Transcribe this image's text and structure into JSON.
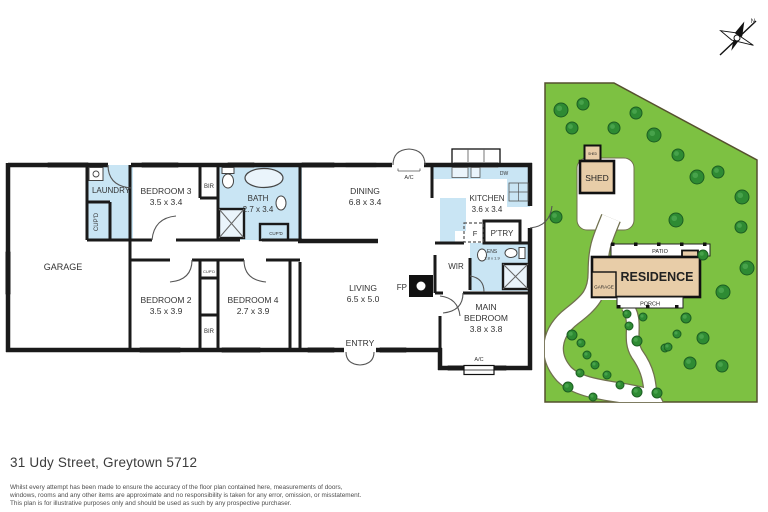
{
  "page": {
    "address": "31 Udy Street, Greytown 5712",
    "disclaimer_lines": [
      "Whilst every attempt has been made to ensure the accuracy of the floor plan contained here, measurements of doors,",
      "windows, rooms and any other items are approximate and no responsibility is taken for any error, omission, or misstatement.",
      "This plan is for illustrative purposes only and should be used as such by any prospective purchaser."
    ]
  },
  "compass": {
    "north_label": "N"
  },
  "floor_plan": {
    "wet_area_color": "#c9e5f4",
    "wall_color": "#1a1a1a",
    "rooms": [
      {
        "id": "garage",
        "lines": [
          "GARAGE"
        ],
        "x": 63,
        "y": 270,
        "size": 9
      },
      {
        "id": "laundry",
        "lines": [
          "LAUNDRY"
        ],
        "x": 111,
        "y": 193,
        "size": 8
      },
      {
        "id": "bedroom-3",
        "lines": [
          "BEDROOM 3",
          "3.5 x 3.4"
        ],
        "x": 166,
        "y": 194,
        "size": 8.5
      },
      {
        "id": "bath",
        "lines": [
          "BATH",
          "2.7 x 3.4"
        ],
        "x": 258,
        "y": 201,
        "size": 8
      },
      {
        "id": "dining",
        "lines": [
          "DINING",
          "6.8 x 3.4"
        ],
        "x": 365,
        "y": 194,
        "size": 8.5
      },
      {
        "id": "kitchen",
        "lines": [
          "KITCHEN",
          "3.6 x 3.4"
        ],
        "x": 487,
        "y": 201,
        "size": 8
      },
      {
        "id": "living",
        "lines": [
          "LIVING",
          "6.5 x 5.0"
        ],
        "x": 363,
        "y": 291,
        "size": 8.5
      },
      {
        "id": "bedroom-2",
        "lines": [
          "BEDROOM 2",
          "3.5 x 3.9"
        ],
        "x": 166,
        "y": 303,
        "size": 8.5
      },
      {
        "id": "bedroom-4",
        "lines": [
          "BEDROOM 4",
          "2.7 x 3.9"
        ],
        "x": 253,
        "y": 303,
        "size": 8.5
      },
      {
        "id": "main-bedroom",
        "lines": [
          "MAIN",
          "BEDROOM",
          "3.8 x 3.8"
        ],
        "x": 486,
        "y": 310,
        "size": 8.5
      },
      {
        "id": "wir",
        "lines": [
          "WIR"
        ],
        "x": 456,
        "y": 269,
        "size": 8
      },
      {
        "id": "entry",
        "lines": [
          "ENTRY"
        ],
        "x": 360,
        "y": 346,
        "size": 8.5
      }
    ],
    "small_labels": [
      {
        "id": "bir-bed3",
        "text": "BIR",
        "x": 209,
        "y": 188,
        "size": 6
      },
      {
        "id": "cupd-laundry",
        "text": "CUP'D",
        "x": 98,
        "y": 222,
        "size": 6,
        "rotate": -90
      },
      {
        "id": "cupd-bath",
        "text": "CUP'D",
        "x": 276,
        "y": 235,
        "size": 4.5
      },
      {
        "id": "cupd-hall",
        "text": "CUP'D",
        "x": 209,
        "y": 273,
        "size": 4
      },
      {
        "id": "bir-hall",
        "text": "BIR",
        "x": 209,
        "y": 333,
        "size": 6
      },
      {
        "id": "dw",
        "text": "DW",
        "x": 504,
        "y": 175,
        "size": 5
      },
      {
        "id": "fridge",
        "text": "F",
        "x": 475,
        "y": 236,
        "size": 7.5
      },
      {
        "id": "pantry",
        "text": "P'TRY",
        "x": 502,
        "y": 236,
        "size": 8
      },
      {
        "id": "ens",
        "text": "ENS",
        "x": 492,
        "y": 253,
        "size": 5
      },
      {
        "id": "ens-dims",
        "text": "1.8 x 1.9",
        "x": 492,
        "y": 259.5,
        "size": 4
      },
      {
        "id": "fp",
        "text": "FP",
        "x": 407,
        "y": 290,
        "size": 8,
        "anchor": "end"
      },
      {
        "id": "ac-dining",
        "text": "A/C",
        "x": 409,
        "y": 179,
        "size": 5.5
      },
      {
        "id": "ac-mainbed",
        "text": "A/C",
        "x": 479,
        "y": 361,
        "size": 5.5
      }
    ]
  },
  "site_plan": {
    "colors": {
      "grass": "#7dc142",
      "grass_border": "#55502e",
      "tree": "#2e8b33",
      "tree_dark": "#1c5e22",
      "tree_light": "#5cb65f",
      "building": "#e8cda8",
      "drive_border": "#70704e"
    },
    "labels": [
      {
        "id": "shed",
        "text": "SHED",
        "x": 597,
        "y": 181,
        "size": 8.5
      },
      {
        "id": "small-shed",
        "text": "SHED",
        "x": 592.5,
        "y": 155,
        "size": 3.2
      },
      {
        "id": "residence",
        "text": "RESIDENCE",
        "x": 657,
        "y": 281,
        "size": 12.5,
        "bold": true
      },
      {
        "id": "site-garage",
        "text": "GARAGE",
        "x": 604,
        "y": 288.5,
        "size": 4.6
      },
      {
        "id": "patio",
        "text": "PATIO",
        "x": 660,
        "y": 253,
        "size": 5.5
      },
      {
        "id": "porch",
        "text": "PORCH",
        "x": 650,
        "y": 305.5,
        "size": 5.5
      }
    ],
    "trees": [
      [
        561,
        110,
        7
      ],
      [
        583,
        104,
        6
      ],
      [
        572,
        128,
        6
      ],
      [
        614,
        128,
        6
      ],
      [
        636,
        113,
        6
      ],
      [
        654,
        135,
        7
      ],
      [
        678,
        155,
        6
      ],
      [
        697,
        177,
        7
      ],
      [
        718,
        172,
        6
      ],
      [
        742,
        197,
        7
      ],
      [
        556,
        217,
        6
      ],
      [
        676,
        220,
        7
      ],
      [
        741,
        227,
        6
      ],
      [
        747,
        268,
        7
      ],
      [
        723,
        292,
        7
      ],
      [
        703,
        338,
        6
      ],
      [
        690,
        363,
        6
      ],
      [
        722,
        366,
        6
      ],
      [
        627,
        314,
        4
      ],
      [
        643,
        317,
        4
      ],
      [
        629,
        326,
        4
      ],
      [
        686,
        318,
        5
      ],
      [
        677,
        334,
        4
      ],
      [
        665,
        348,
        4
      ],
      [
        572,
        335,
        5
      ],
      [
        581,
        343,
        4
      ],
      [
        637,
        341,
        5
      ],
      [
        668,
        347,
        4
      ],
      [
        587,
        355,
        4
      ],
      [
        595,
        365,
        4
      ],
      [
        580,
        373,
        4
      ],
      [
        607,
        375,
        4
      ],
      [
        568,
        387,
        5
      ],
      [
        620,
        385,
        4
      ],
      [
        593,
        397,
        4
      ],
      [
        637,
        392,
        5
      ],
      [
        657,
        393,
        5
      ],
      [
        703,
        255,
        5
      ]
    ]
  }
}
